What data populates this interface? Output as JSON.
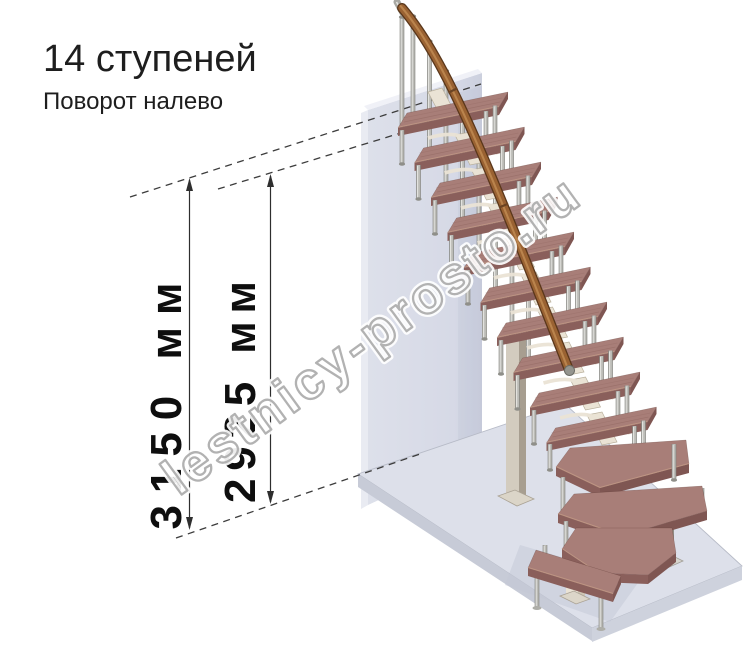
{
  "title": "14 ступеней",
  "subtitle": "Поворот налево",
  "dimensions": {
    "total_height": "3150 мм",
    "to_top_step": "2925 мм"
  },
  "watermark": "lestnicy-prosto.ru",
  "steps_count": "14",
  "palette": {
    "wall": "#d8dbe7",
    "wallLight": "#e9ebf2",
    "wallTop": "#f0f1f7",
    "floorTop": "#dde0ea",
    "floorSideL": "#c7cbd7",
    "floorSideR": "#ced2dd",
    "floorEdge": "#b7bbc7",
    "treadTop": "#a87e78",
    "treadFront": "#8a5f5b",
    "treadEnd": "#7f5652",
    "nosing": "#c9a089",
    "grain": "#8d625c",
    "rail": "#9a6232",
    "railDark": "#5a371b",
    "railHi": "#c08b52",
    "metal": "#bcbcb7",
    "metalHi": "#e4e4e0",
    "metalDark": "#82827c",
    "collar": "#8f8f89",
    "cream": "#eae3d5",
    "creamDark": "#cfc6b4",
    "creamEdge": "#b9b09c",
    "dash": "#3c3c3c",
    "dimLine": "#2e2e2e",
    "shadow": "#c3c8d5"
  }
}
